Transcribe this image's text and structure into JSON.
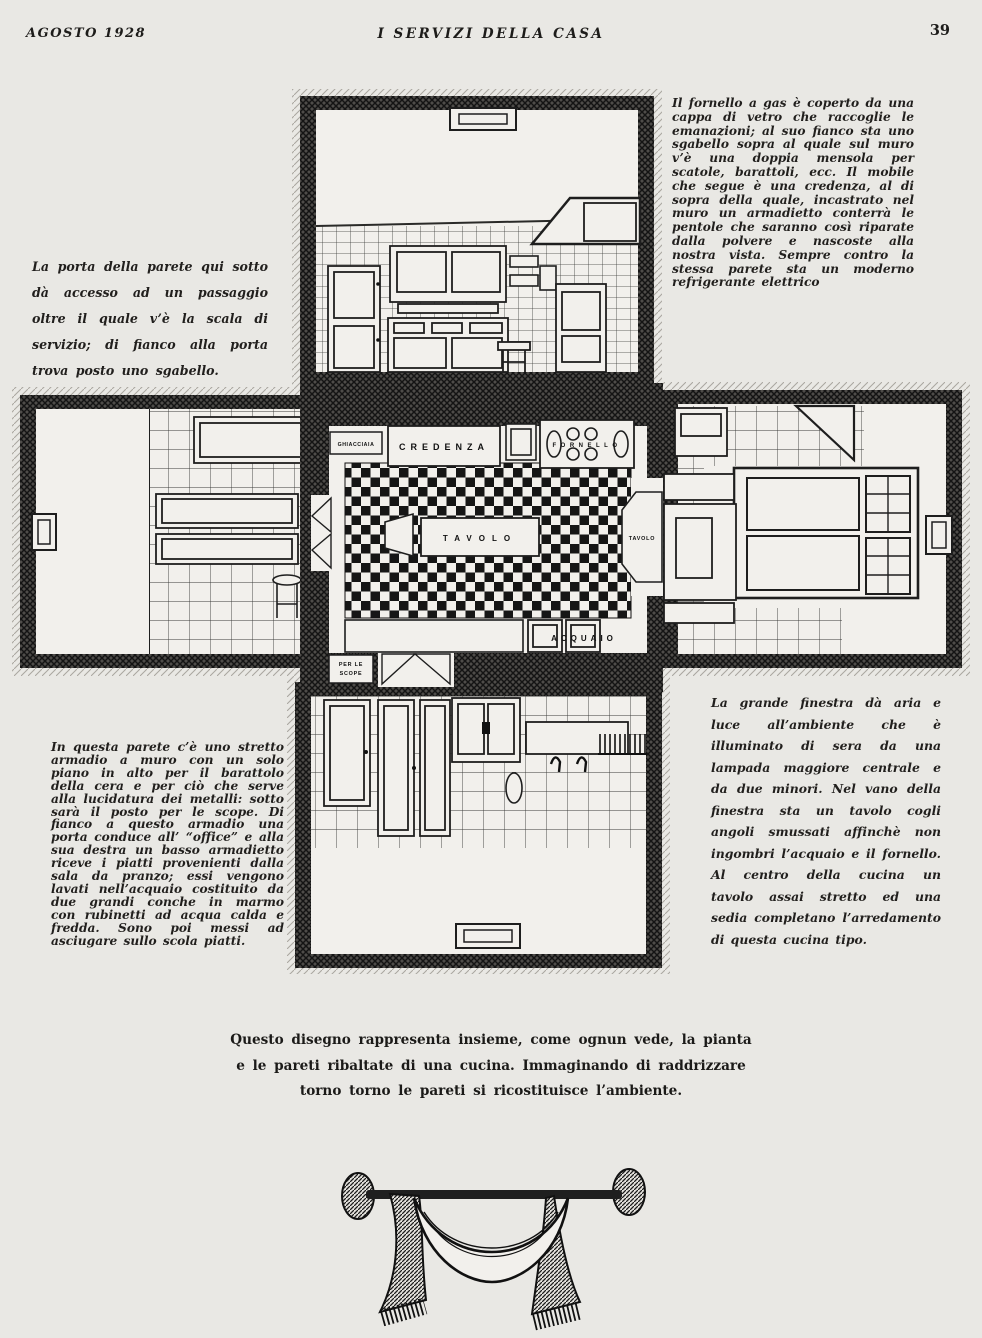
{
  "header": {
    "left": "AGOSTO 1928",
    "center": "I SERVIZI DELLA CASA",
    "page_number": "39"
  },
  "text_blocks": {
    "top_right": "Il fornello a gas è coperto da una cappa di vetro che raccoglie le emanazioni; al suo fianco sta uno sgabello sopra al quale sul muro v’è una doppia mensola per scatole, barattoli, ecc. Il mobile che segue è una credenza, al di sopra della quale, incastrato nel muro un armadietto conterrà le pentole che saranno così riparate dalla polvere e nascoste alla nostra vista. Sempre contro la stessa parete sta un moderno refrigerante elettrico",
    "mid_left": "La porta della parete qui sotto dà accesso ad un passaggio oltre il quale v’è la scala di servizio; di fianco alla porta trova posto uno sgabello.",
    "bottom_left": "In questa parete c’è uno stretto armadio a muro con un solo piano in alto per il barattolo della cera e per ciò che serve alla lucidatura dei metalli: sotto sarà il posto per le scope. Di fianco a questo armadio una porta conduce all’ “office” e alla sua destra un basso armadietto riceve i piatti provenienti dalla sala da pranzo; essi vengono lavati nell’acquaio costituito da due grandi conche in marmo con rubinetti ad acqua calda e fredda. Sono poi messi ad asciugare sullo scola piatti.",
    "mid_right": "La grande finestra dà aria e luce all’ambiente che è illuminato di sera da una lampada maggiore centrale e da due minori. Nel vano della finestra sta un tavolo cogli angoli smussati affinchè non ingombri l’acquaio e il fornello. Al centro della cucina un tavolo assai stretto ed una sedia completano l’arredamento di questa cucina tipo.",
    "caption_line1": "Questo disegno rappresenta insieme, come ognun vede, la pianta",
    "caption_line2": "e le pareti ribaltate di una cucina. Immaginando di raddrizzare",
    "caption_line3": "torno torno le pareti si ricostituisce l’ambiente."
  },
  "plan_labels": {
    "ghiacciaia": "GHIACCIAIA",
    "credenza": "CREDENZA",
    "fornello": "FORNELLO",
    "tavolo_center": "TAVOLO",
    "tavolo_window": "TAVOLO",
    "acquaio": "ACQUAIO",
    "scope_line1": "PER LE",
    "scope_line2": "SCOPE"
  },
  "colors": {
    "paper": "#e9e8e4",
    "ink": "#1d1c1a"
  }
}
